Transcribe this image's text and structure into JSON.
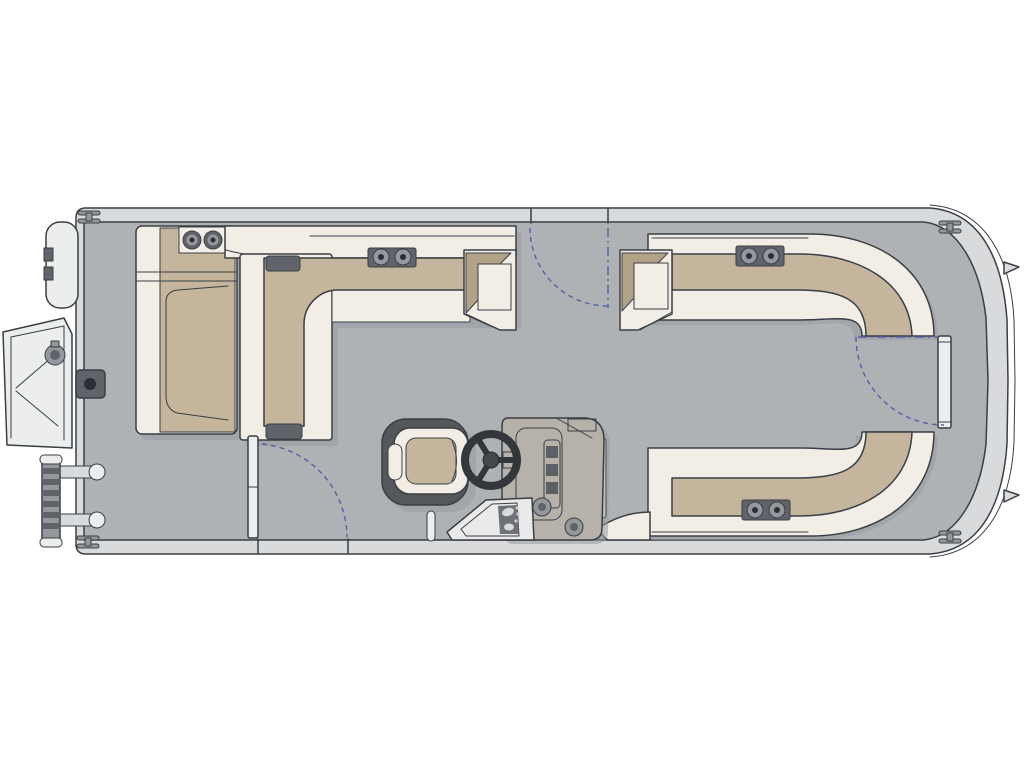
{
  "title": "Pontoon boat floor plan (top view)",
  "colors": {
    "bg": "#ffffff",
    "deck": "#afb2b5",
    "hull_band": "#d8dadc",
    "outline": "#3a3f45",
    "upholstery_white": "#f2eee6",
    "hardware_white": "#eceded",
    "cushion_tan": "#c4b59c",
    "cushion_tan_dark": "#b1a288",
    "hardware_dark": "#60646a",
    "hardware_mid": "#94989d",
    "chair_wrap": "#54585d",
    "console_body": "#b6b1a9",
    "console_panel": "#c2beb6",
    "console_dark": "#43474c",
    "gate_arc_blue": "#5560a4",
    "shadow": "#979ba1"
  },
  "components": {
    "hull": "pontoon hull with bow at right, stern at left",
    "cleats": 4,
    "gate_swing_arcs": 3,
    "port_stern_chaise": "chaise lounge with twin cup holders",
    "port_l_couch": "L-shaped couch with corner seat and armrest",
    "starboard_bow_couch": "wrap-around bow couch with twin cup holders",
    "starboard_aft_couch": "wrap-around couch with twin cup holders",
    "helm": "console with steering wheel, gauges, switch panel, two cup holders",
    "captains_chair": "swivel captain's chair",
    "stern_boarding_gate": "gate swung open on port stern side",
    "boarding_ladder": "folded ladder with two rails",
    "bow_gate": "closed bow gate",
    "deck_fitting": "square deck fitting with socket"
  }
}
